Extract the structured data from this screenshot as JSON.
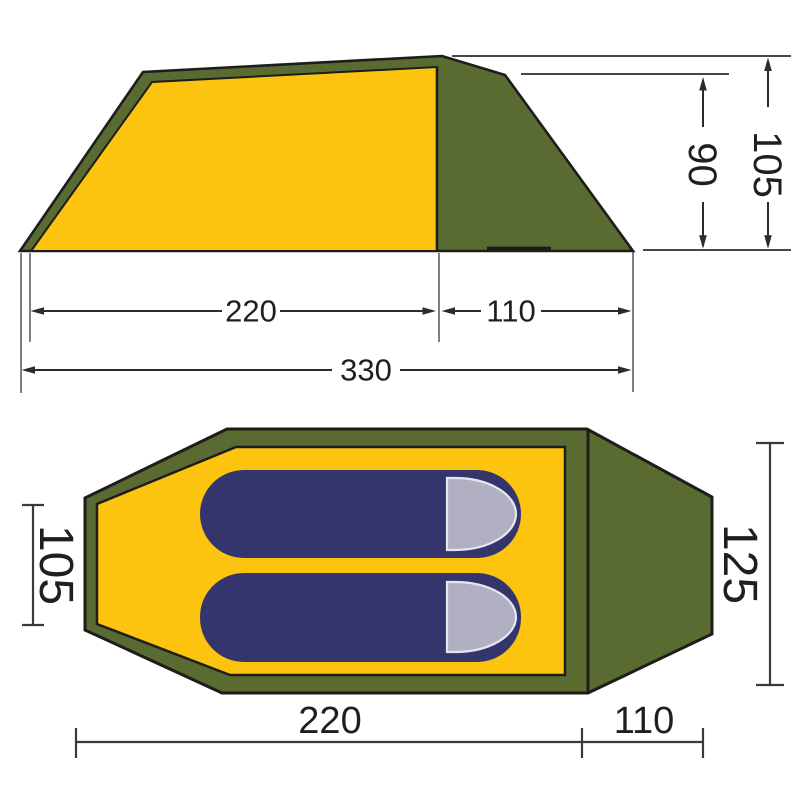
{
  "colors": {
    "tent_yellow": "#fcc40e",
    "olive_green": "#5a6b31",
    "sleeping_bag_navy": "#35356d",
    "hood_gray": "#b1afc2",
    "hood_highlight": "#e6e6ef",
    "outline_black": "#1d1d1b",
    "dimension_line": "#2b2b2b"
  },
  "side_view": {
    "inner_width": "220",
    "vestibule_width": "110",
    "total_width": "330",
    "vestibule_height": "90",
    "peak_height": "105"
  },
  "top_view": {
    "head_width": "105",
    "foot_width": "125",
    "inner_length": "220",
    "vestibule_length": "110"
  }
}
